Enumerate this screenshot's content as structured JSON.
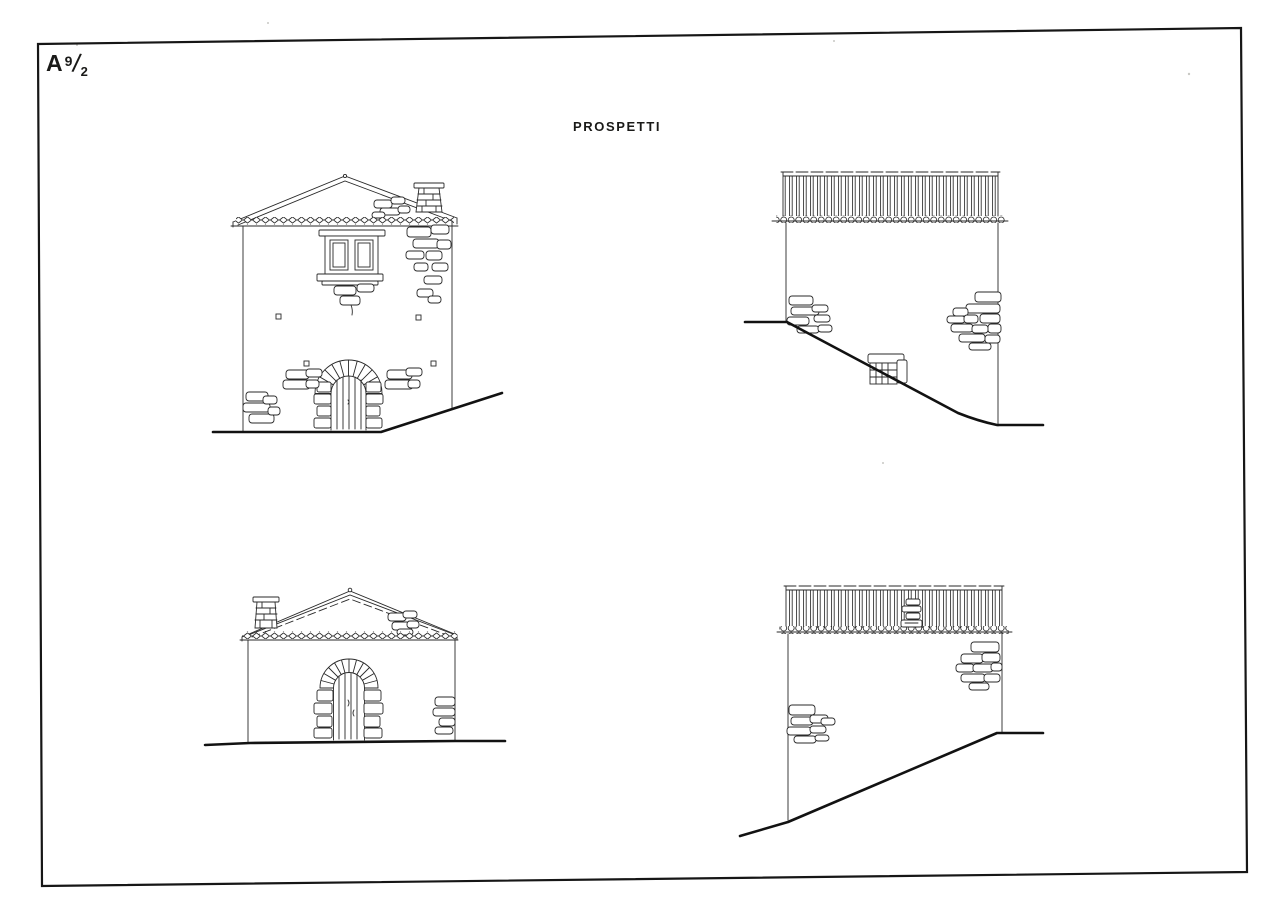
{
  "sheet": {
    "series": "A",
    "number": "9",
    "separator": "/",
    "sub_number": "2"
  },
  "title": "PROSPETTI",
  "figures": {
    "top_left": "front-elevation-gable-roof-arched-door-window",
    "top_right": "side-elevation-on-downhill-slope",
    "bottom_left": "rear-elevation-gable-roof-arched-door",
    "bottom_right": "side-elevation-on-uphill-slope-with-chimney"
  },
  "colors": {
    "ink": "#2a2a2a",
    "heavy_line": "#121212",
    "paper": "#ffffff"
  }
}
